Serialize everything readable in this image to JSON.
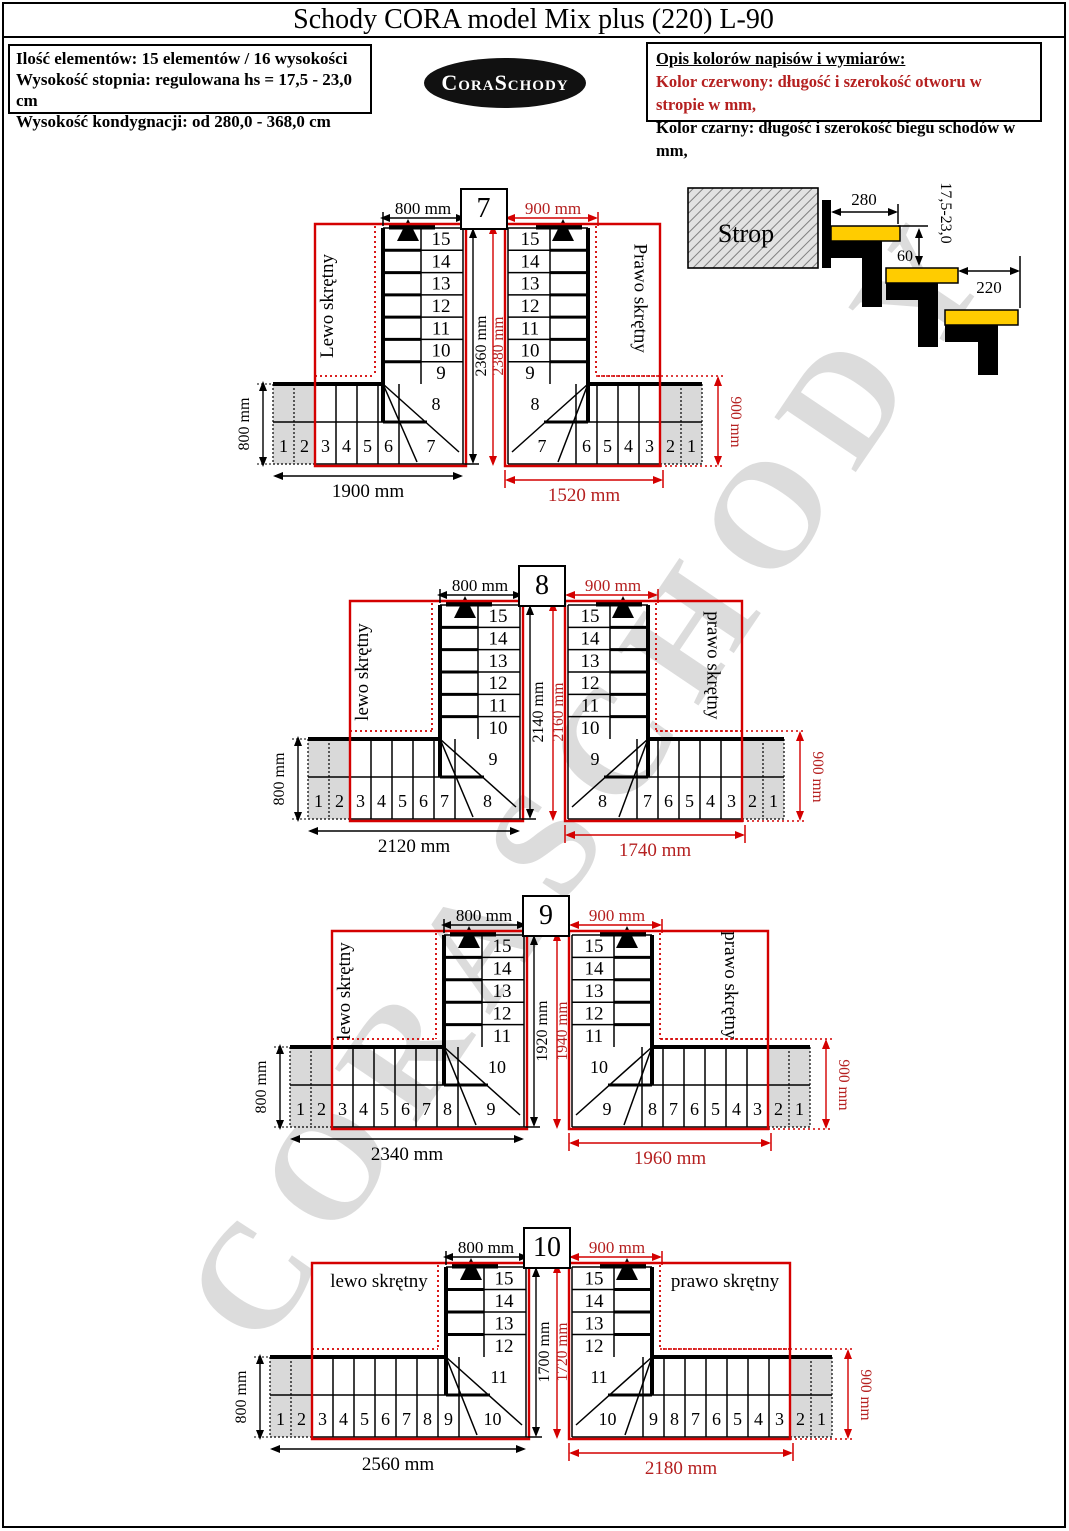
{
  "page": {
    "title": "Schody CORA model Mix plus (220) L-90",
    "watermark": "CORASCHODY"
  },
  "info_box": {
    "lines": [
      "Ilość elementów: 15 elementów / 16 wysokości",
      "Wysokość stopnia: regulowana  hs = 17,5 - 23,0 cm",
      "Wysokość kondygnacji: od 280,0 - 368,0 cm"
    ]
  },
  "logo": {
    "text": "CoraSchody"
  },
  "legend_box": {
    "title": "Opis kolorów napisów i wymiarów:",
    "red_line": "Kolor czerwony:  długość i szerokość otworu w stropie w mm,",
    "black_line": "Kolor czarny:  długość i szerokość biegu schodów w mm,"
  },
  "section_sketch": {
    "slab_label": "Strop",
    "top_tread_depth": "280",
    "riser_range": "17,5-23,0",
    "nosing_overlap": "60",
    "tread_depth": "220"
  },
  "colors": {
    "red": "#d40000",
    "red_text": "#b52020",
    "black": "#000000",
    "tread_yellow": "#ffcc00",
    "entry_gray": "#d9d9d9",
    "watermark_gray": "#c6c6c6"
  },
  "variants": [
    {
      "number": "7",
      "left": {
        "direction_label": "Lewo skrętny",
        "flight_width_dim": "800 mm",
        "entry_width_dim": "800 mm",
        "run_length_dim": "1900 mm",
        "run_height_dim": "2360 mm",
        "flight_steps": [
          "15",
          "14",
          "13",
          "12",
          "11",
          "10",
          "9"
        ],
        "turn_step": "8",
        "bottom_steps": [
          "1",
          "2",
          "3",
          "4",
          "5",
          "6",
          "7"
        ]
      },
      "right": {
        "direction_label": "Prawo skrętny",
        "opening_width_dim": "900 mm",
        "opening_length_dim": "2380 mm",
        "opening_run_dim": "1520 mm",
        "opening_side_dim": "900 mm",
        "flight_steps": [
          "15",
          "14",
          "13",
          "12",
          "11",
          "10",
          "9"
        ],
        "turn_step": "8",
        "bottom_steps": [
          "7",
          "6",
          "5",
          "4",
          "3",
          "2",
          "1"
        ]
      }
    },
    {
      "number": "8",
      "left": {
        "direction_label": "lewo skrętny",
        "flight_width_dim": "800 mm",
        "entry_width_dim": "800 mm",
        "run_length_dim": "2120 mm",
        "run_height_dim": "2140 mm",
        "flight_steps": [
          "15",
          "14",
          "13",
          "12",
          "11",
          "10"
        ],
        "turn_step": "9",
        "bottom_steps": [
          "1",
          "2",
          "3",
          "4",
          "5",
          "6",
          "7",
          "8"
        ]
      },
      "right": {
        "direction_label": "prawo skrętny",
        "opening_width_dim": "900 mm",
        "opening_length_dim": "2160 mm",
        "opening_run_dim": "1740 mm",
        "opening_side_dim": "900 mm",
        "flight_steps": [
          "15",
          "14",
          "13",
          "12",
          "11",
          "10"
        ],
        "turn_step": "9",
        "bottom_steps": [
          "8",
          "7",
          "6",
          "5",
          "4",
          "3",
          "2",
          "1"
        ]
      }
    },
    {
      "number": "9",
      "left": {
        "direction_label": "lewo skrętny",
        "flight_width_dim": "800 mm",
        "entry_width_dim": "800 mm",
        "run_length_dim": "2340 mm",
        "run_height_dim": "1920 mm",
        "flight_steps": [
          "15",
          "14",
          "13",
          "12",
          "11"
        ],
        "turn_step": "10",
        "bottom_steps": [
          "1",
          "2",
          "3",
          "4",
          "5",
          "6",
          "7",
          "8",
          "9"
        ]
      },
      "right": {
        "direction_label": "prawo skrętny",
        "opening_width_dim": "900 mm",
        "opening_length_dim": "1940 mm",
        "opening_run_dim": "1960 mm",
        "opening_side_dim": "900 mm",
        "flight_steps": [
          "15",
          "14",
          "13",
          "12",
          "11"
        ],
        "turn_step": "10",
        "bottom_steps": [
          "9",
          "8",
          "7",
          "6",
          "5",
          "4",
          "3",
          "2",
          "1"
        ]
      }
    },
    {
      "number": "10",
      "left": {
        "direction_label": "lewo skrętny",
        "flight_width_dim": "800 mm",
        "entry_width_dim": "800 mm",
        "run_length_dim": "2560 mm",
        "run_height_dim": "1700 mm",
        "flight_steps": [
          "15",
          "14",
          "13",
          "12"
        ],
        "turn_step": "11",
        "bottom_steps": [
          "1",
          "2",
          "3",
          "4",
          "5",
          "6",
          "7",
          "8",
          "9",
          "10"
        ]
      },
      "right": {
        "direction_label": "prawo skrętny",
        "opening_width_dim": "900 mm",
        "opening_length_dim": "1720 mm",
        "opening_run_dim": "2180 mm",
        "opening_side_dim": "900 mm",
        "flight_steps": [
          "15",
          "14",
          "13",
          "12"
        ],
        "turn_step": "11",
        "bottom_steps": [
          "10",
          "9",
          "8",
          "7",
          "6",
          "5",
          "4",
          "3",
          "2",
          "1"
        ]
      }
    }
  ]
}
